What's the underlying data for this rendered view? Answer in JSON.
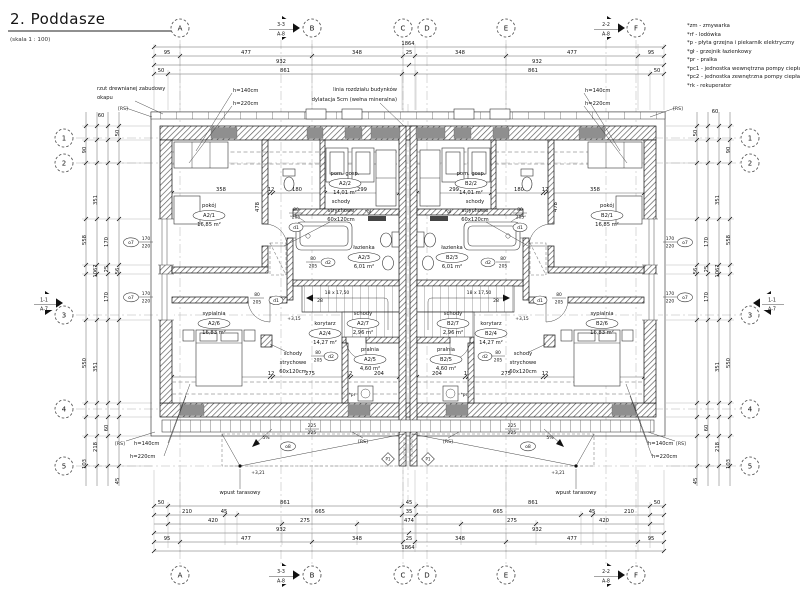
{
  "title": {
    "text": "2. Poddasze",
    "scale": "(skala 1 : 100)"
  },
  "legend": [
    "*zm - zmywarka",
    "*rf - lodówka",
    "*p - płyta grzejna i piekarnik elektryczny",
    "*gł - grzejnik łazienkowy",
    "*pr - pralka",
    "*pc1 - jednostka wewnętrzna pompy ciepła",
    "*pc2 - jednostka zewnętrzna pompy ciepła",
    "*rk - rekuperator"
  ],
  "grid": {
    "cols": [
      "A",
      "B",
      "C",
      "D",
      "E",
      "F"
    ],
    "rows": [
      "1",
      "2",
      "3",
      "4",
      "5"
    ]
  },
  "sections": {
    "s33": "3-3",
    "s22": "2-2",
    "s11": "1-1",
    "sheet8": "A-8",
    "sheet7": "A-7"
  },
  "rooms": {
    "names": [
      "pokój",
      "pom. gosp.",
      "łazienka",
      "korytarz",
      "pralnia",
      "sypialnia",
      "schody"
    ],
    "unit_a": [
      "A2/1",
      "A2/2",
      "A2/3",
      "A2/4",
      "A2/5",
      "A2/6",
      "A2/7"
    ],
    "unit_b": [
      "B2/1",
      "B2/2",
      "B2/3",
      "B2/4",
      "B2/5",
      "B2/6",
      "B2/7"
    ],
    "areas": [
      "16,85 m²",
      "14,01 m²",
      "6,01 m²",
      "14,27 m²",
      "4,60 m²",
      "16,83 m²",
      "2,96 m²"
    ]
  },
  "openings": {
    "d1": "d1",
    "d2": "d2",
    "o7": "o7",
    "o8": "o8",
    "w80": "80",
    "w205": "205",
    "w170": "170",
    "w220": "220",
    "w225": "225"
  },
  "stairs": {
    "run": "18 x 17,50",
    "going": "28"
  },
  "annotations": {
    "okap1": "rzut drewnianej zabudowy",
    "okap2": "okapu",
    "dyl1": "linia rozdziału budynków",
    "dyl2": "dylatacja 5cm (wełna mineralna)",
    "h140": "h=140cm",
    "h220": "h=220cm",
    "ss1": "schody",
    "ss2": "strychowe",
    "ss3": "60x120cm",
    "wpust": "wpust tarasowy",
    "rs": "[RS]",
    "slope": "5%",
    "p1": "P1",
    "pr": "*pr",
    "gl": "*gł",
    "lvl_a": "+3,15",
    "lvl_t": "+3,21"
  },
  "dims": {
    "total": "1864",
    "top1": [
      "95",
      "477",
      "348",
      "25",
      "348",
      "477",
      "95"
    ],
    "spans": [
      "932",
      "932"
    ],
    "top3": [
      "50",
      "861",
      "861",
      "50"
    ],
    "bot1": [
      "50",
      "861",
      "45",
      "861",
      "50"
    ],
    "bot2": [
      "210",
      "45",
      "665",
      "35",
      "665",
      "45",
      "210"
    ],
    "bot3": [
      "420",
      "275",
      "474",
      "275",
      "420"
    ],
    "left": [
      "60",
      "50",
      "90",
      "351",
      "558",
      "170",
      "25",
      "1067",
      "170",
      "550",
      "351",
      "60",
      "218",
      "103",
      "45",
      "56"
    ],
    "inner_top": [
      "358",
      "12",
      "180",
      "12",
      "299"
    ],
    "inner_bot": [
      "358",
      "12",
      "275",
      "12",
      "204"
    ],
    "d478": "478",
    "d100": "100"
  },
  "colors": {
    "ink": "#141414",
    "window_block": "#8f8f8f"
  }
}
